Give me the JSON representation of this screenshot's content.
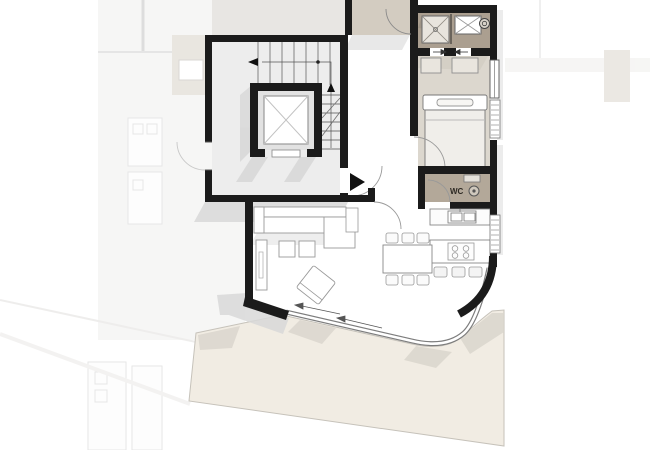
{
  "plan": {
    "label_wc": "WC",
    "colors": {
      "wall": "#1b1b1b",
      "corridor_floor": "#e8e6e3",
      "vestibule_floor": "#d3ccc1",
      "stairwell_floor": "#ededed",
      "elevator_floor": "#e2e2e2",
      "bathroom_floor": "#ab9f90",
      "bedroom_floor": "#dcd7ce",
      "wc_floor": "#b3a899",
      "closet_fill": "#e9e5de",
      "furniture_fill": "#ffffff",
      "furniture_line": "#8f8f8f",
      "terrace": "#f1ece3",
      "terrace_shadow": "#d9d5cc",
      "shadow": "#d9d9d9",
      "glass_line": "#7d7d7d",
      "neighbor_fill": "#efeeec",
      "neighbor_tan": "#d5cec3",
      "wc_text": "#2e2a24"
    },
    "icons": [
      "elevator-icon",
      "stairs-icon",
      "shower-icon",
      "bathtub-icon",
      "washing-machine-icon",
      "kitchen-sink-icon",
      "cooktop-icon",
      "toilet-icon",
      "door-swing-icon",
      "sliding-door-arrow-icon",
      "stair-direction-arrow-icon",
      "exit-arrow-icon"
    ]
  }
}
